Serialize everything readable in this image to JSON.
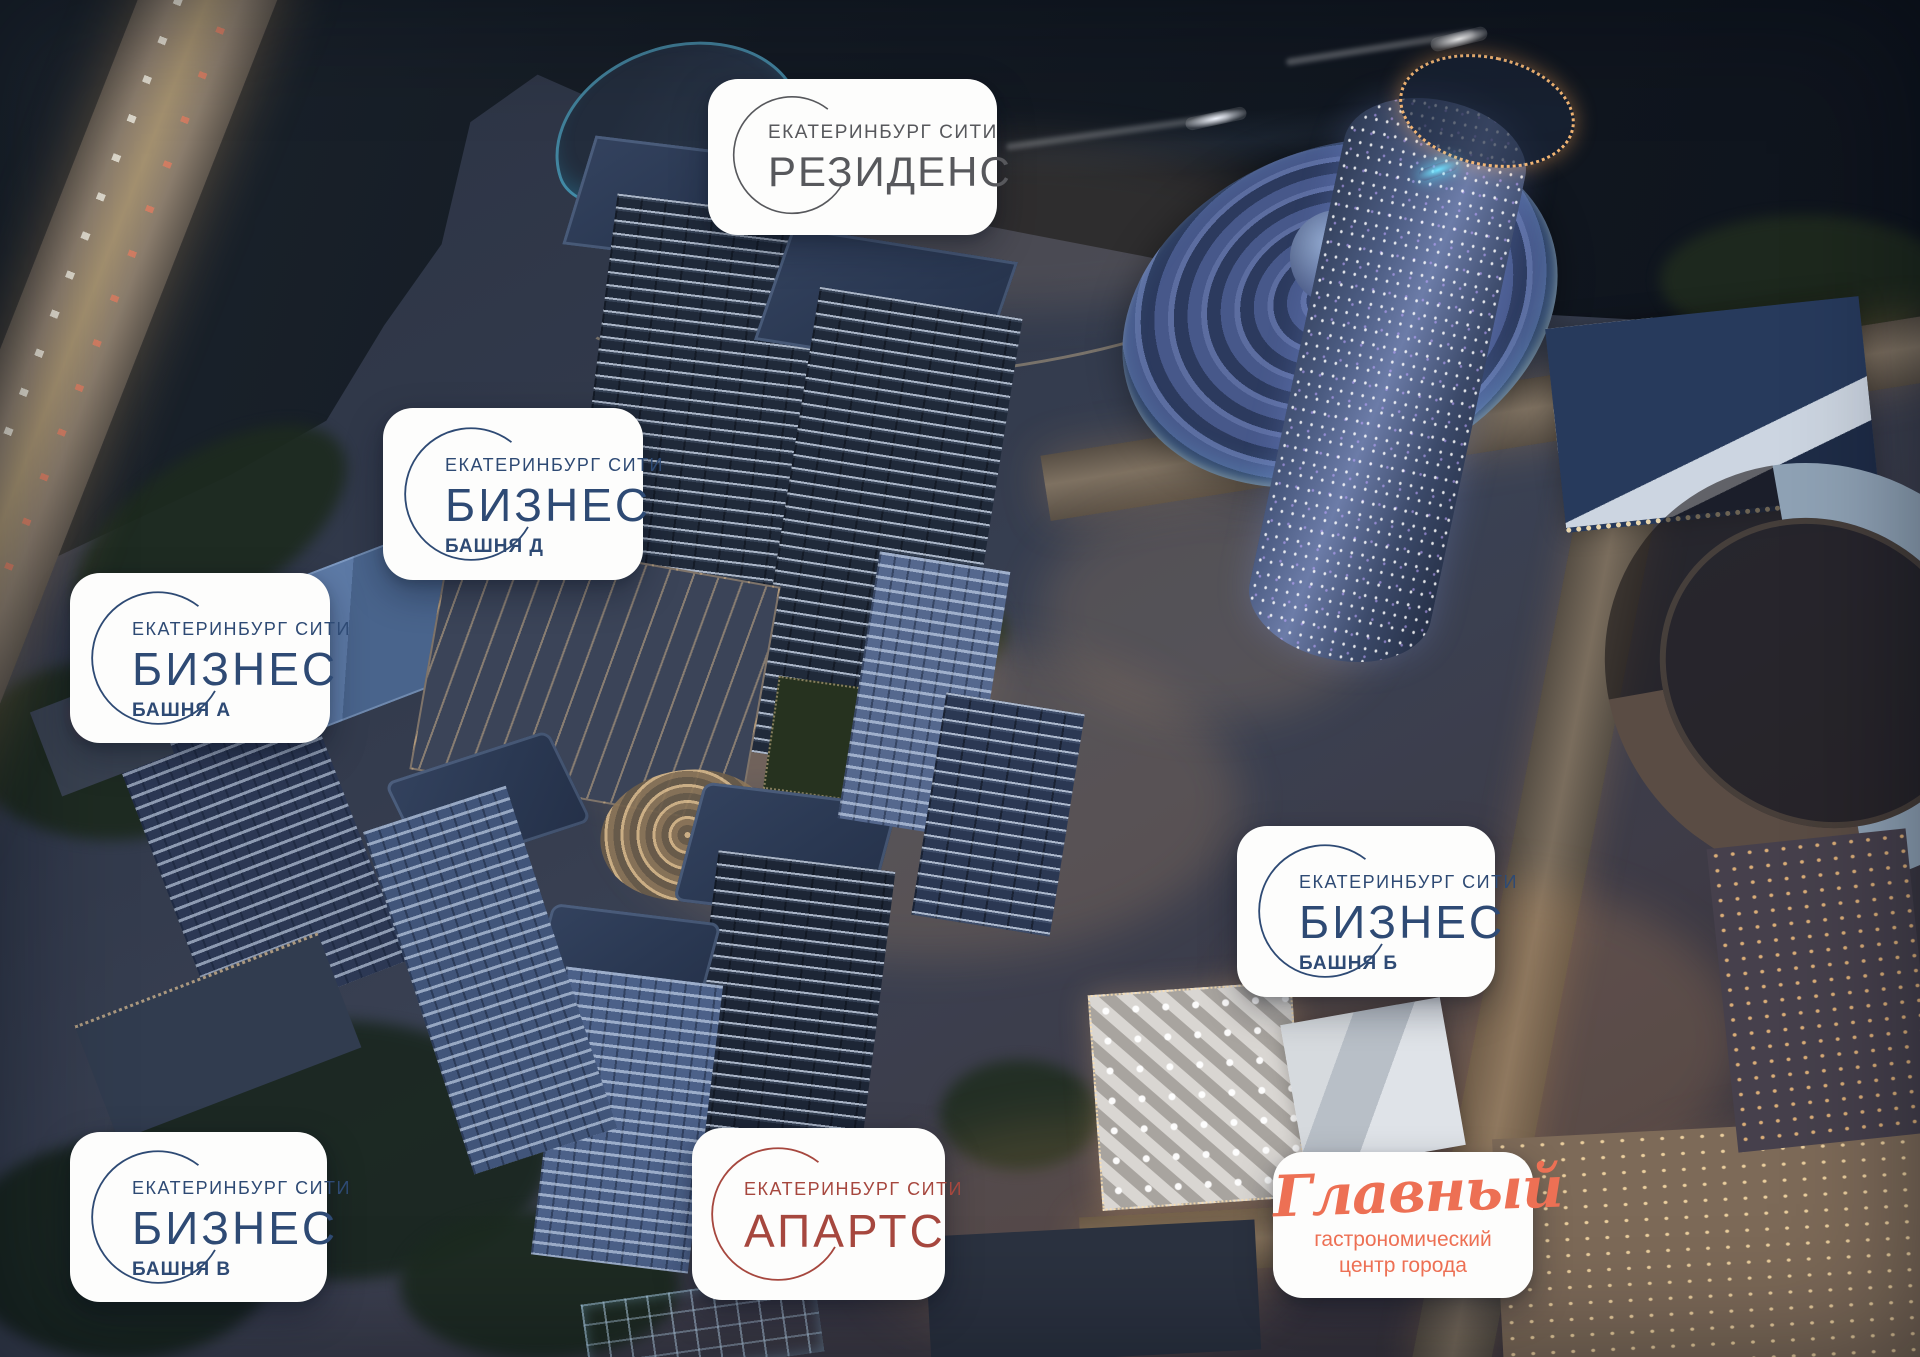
{
  "cards": {
    "residence": {
      "brand": "ЕКАТЕРИНБУРГ СИТИ",
      "title": "РЕЗИДЕНС",
      "accent": "#57585c"
    },
    "business_d": {
      "brand": "ЕКАТЕРИНБУРГ СИТИ",
      "title": "БИЗНЕС",
      "subtitle": "БАШНЯ Д",
      "accent": "#2e4a74"
    },
    "business_a": {
      "brand": "ЕКАТЕРИНБУРГ СИТИ",
      "title": "БИЗНЕС",
      "subtitle": "БАШНЯ А",
      "accent": "#2e4a74"
    },
    "business_b": {
      "brand": "ЕКАТЕРИНБУРГ СИТИ",
      "title": "БИЗНЕС",
      "subtitle": "БАШНЯ Б",
      "accent": "#2e4a74"
    },
    "business_v": {
      "brand": "ЕКАТЕРИНБУРГ СИТИ",
      "title": "БИЗНЕС",
      "subtitle": "БАШНЯ В",
      "accent": "#2e4a74"
    },
    "aparts": {
      "brand": "ЕКАТЕРИНБУРГ СИТИ",
      "title": "АПАРТС",
      "accent": "#a6473e"
    },
    "glavny": {
      "title": "Главный",
      "subtitle_line1": "гастрономический",
      "subtitle_line2": "центр города",
      "accent": "#ed7054"
    }
  }
}
